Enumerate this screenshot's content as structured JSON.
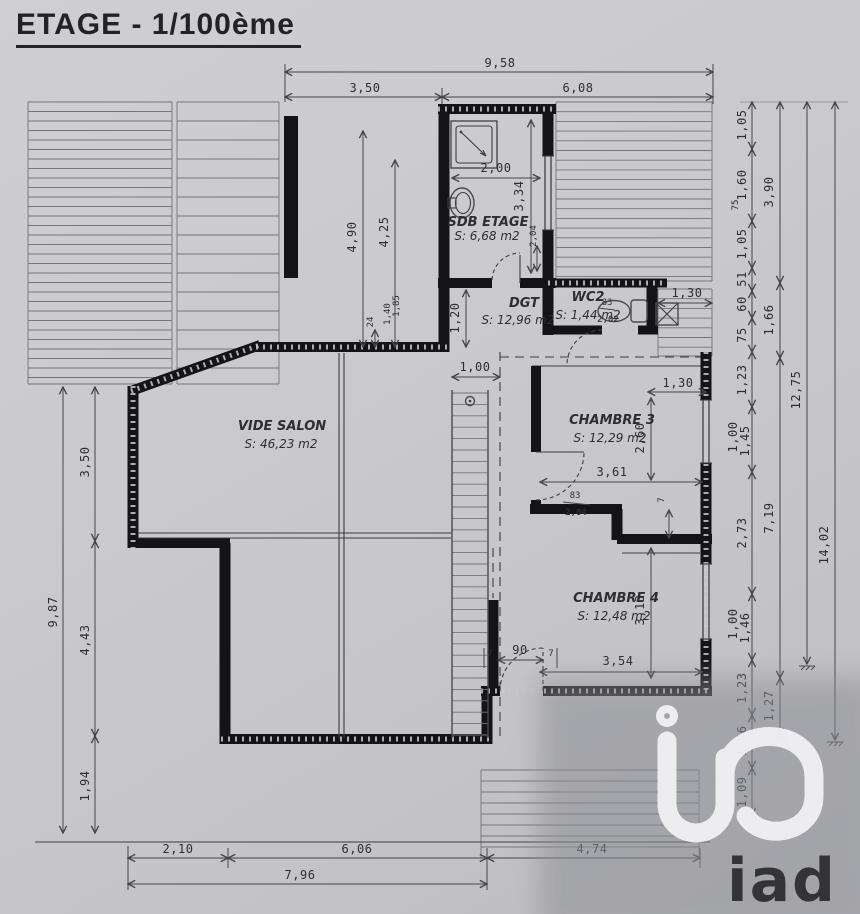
{
  "title": "ETAGE - 1/100ème",
  "rooms": {
    "sdb": {
      "name": "SDB ETAGE",
      "area": "S: 6,68 m2"
    },
    "dgt": {
      "name": "DGT",
      "area": "S: 12,96 m2"
    },
    "wc2": {
      "name": "WC2",
      "area": "S: 1,44 m2",
      "door_width": "83",
      "door_height": "2,02"
    },
    "chambre3": {
      "name": "CHAMBRE 3",
      "area": "S: 12,29 m2",
      "door_width": "83",
      "door_height": "2,04"
    },
    "chambre4": {
      "name": "CHAMBRE 4",
      "area": "S: 12,48 m2"
    },
    "salon": {
      "name": "VIDE SALON",
      "area": "S: 46,23 m2"
    }
  },
  "dims": {
    "top_total": "9,58",
    "top_left": "3,50",
    "top_right": "6,08",
    "left_total": "9,87",
    "left_1": "3,50",
    "left_2": "4,43",
    "left_3": "1,94",
    "bottom_1": "2,10",
    "bottom_2": "6,06",
    "bottom_3": "4,74",
    "bottom_total": "7,96",
    "right_col1": [
      "1,05",
      "1,60",
      "75",
      "1,05",
      "51",
      "60",
      "75",
      "1,23",
      "1,00",
      "1,45",
      "2,73",
      "1,00",
      "1,46",
      "1,23",
      "1,46",
      "1,09"
    ],
    "right_col2": [
      "3,90",
      "1,66",
      "7,19",
      "1,27"
    ],
    "right_col3": "12,75",
    "right_col4": "14,02",
    "sdb_width": "2,00",
    "sdb_height": "3,34",
    "sdb_door": "2,04",
    "roof_1": "4,90",
    "roof_2": "4,25",
    "wall_24": "24",
    "h_140": "1,40",
    "h_185": "1,85",
    "dgt_120": "1,20",
    "stair_100": "1,00",
    "wc_window": "1,30",
    "ch3_window": "1,30",
    "ch3_width": "3,61",
    "ch3_height": "2,60",
    "ch4_width": "3,54",
    "ch4_height": "3,13",
    "ch4_door": "90",
    "t7": "7"
  },
  "logo": {
    "wordmark": "iad"
  },
  "colors": {
    "paper": "#c8c8cb",
    "ink": "#2e2e32",
    "wall": "#141416",
    "shade": "#9b9ba1",
    "logo": "#f2f2f4"
  }
}
